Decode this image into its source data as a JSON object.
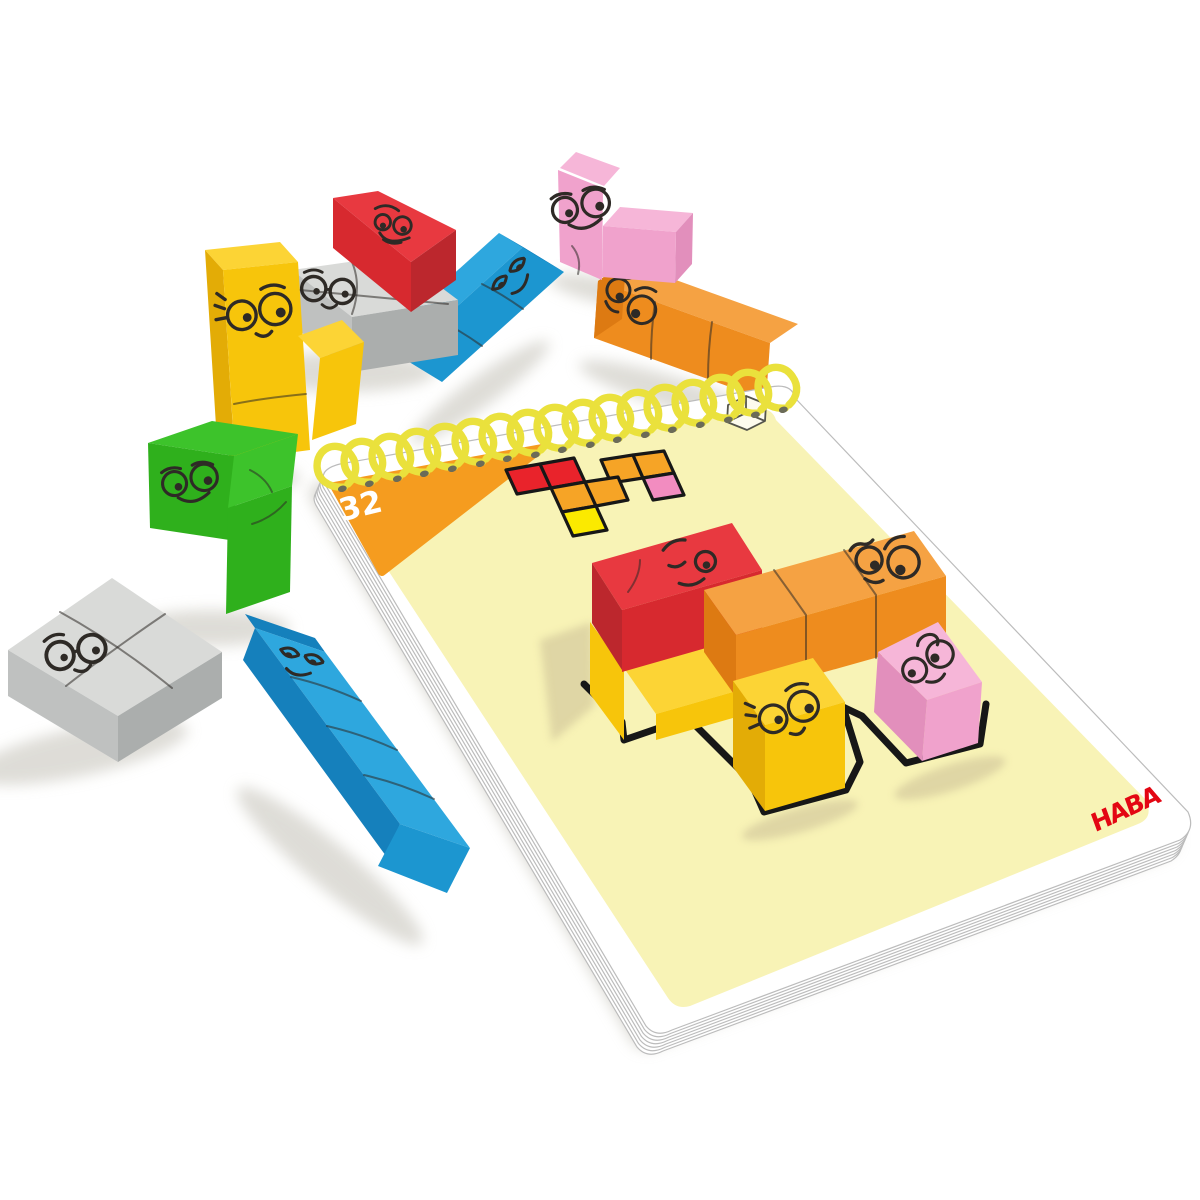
{
  "pad": {
    "brand": "HABA",
    "challenge_number": "32",
    "binding_style": "spiral",
    "icons": [
      {
        "name": "cube-3d-icon"
      }
    ]
  },
  "diagram": {
    "type": "grid",
    "description_icon": "solution-footprint-diagram",
    "cells": [
      {
        "color": "red",
        "col": 0,
        "row": 0
      },
      {
        "color": "red",
        "col": 1,
        "row": 0
      },
      {
        "color": "orange",
        "col": 3,
        "row": 0
      },
      {
        "color": "orange",
        "col": 4,
        "row": 0
      },
      {
        "color": "orange",
        "col": 1,
        "row": 1
      },
      {
        "color": "orange",
        "col": 2,
        "row": 1
      },
      {
        "color": "pink",
        "col": 4,
        "row": 1
      },
      {
        "color": "yellow",
        "col": 1,
        "row": 2
      }
    ]
  },
  "blocks_on_card": [
    {
      "name": "red-rectangle-block",
      "color": "red",
      "expression": "skeptical-face"
    },
    {
      "name": "orange-long-block",
      "color": "orange",
      "expression": "googly-eyes-face"
    },
    {
      "name": "yellow-corner-block",
      "color": "yellow",
      "expression": "sweet-face-with-lashes"
    },
    {
      "name": "pink-corner-block",
      "color": "pink",
      "expression": "dizzy-swirl-face"
    }
  ],
  "loose_blocks": [
    {
      "name": "yellow-l-block",
      "color": "yellow",
      "expression": "smiling-face-with-lashes"
    },
    {
      "name": "red-rectangle-block",
      "color": "red",
      "expression": "mischievous-face"
    },
    {
      "name": "gray-square-block",
      "color": "gray",
      "expression": "glasses-face"
    },
    {
      "name": "pink-t-block",
      "color": "pink",
      "expression": "big-smile-face"
    },
    {
      "name": "blue-long-block",
      "color": "blue",
      "expression": "smug-face"
    },
    {
      "name": "orange-long-block",
      "color": "orange",
      "expression": "googly-eyes-face"
    },
    {
      "name": "green-s-block",
      "color": "green",
      "expression": "happy-face"
    },
    {
      "name": "gray-flat-square-block",
      "color": "gray",
      "expression": "round-glasses-face"
    },
    {
      "name": "blue-extra-long-block",
      "color": "blue",
      "expression": "sleepy-smug-face"
    }
  ],
  "colors": {
    "card": "#F8F3B6",
    "page_edge": "#bcbcbc",
    "table_shadow": "#d6d4cd",
    "card_shadow": "#cfc399",
    "triangle": "#F59C1F",
    "number_text": "#FFFFFF",
    "brand_red": "#E30613",
    "spiral": "#EAE13C",
    "hole": "#6b6b58",
    "outline_ink": "#171717",
    "doodle_ink": "#2e2a26",
    "diagram_red": "#E9232B",
    "diagram_orange": "#F6A426",
    "diagram_yellow": "#FBEA00",
    "diagram_pink": "#F28CC0",
    "red_top": "#E83940",
    "red_front": "#D7292F",
    "red_side": "#BC272D",
    "orange_top": "#F5A243",
    "orange_front": "#EE8C1E",
    "orange_side": "#DD7A12",
    "yellow_top": "#FCD435",
    "yellow_front": "#F7C50B",
    "yellow_side": "#E3AC06",
    "green_top": "#3DC32B",
    "green_front": "#2FB01C",
    "green_side": "#27A015",
    "blue_top": "#2EA7DE",
    "blue_front": "#1C96D0",
    "blue_side": "#1580BC",
    "pink_top": "#F6B6D8",
    "pink_front": "#F0A2CC",
    "pink_side": "#E28FBC",
    "gray_top": "#D9DAD8",
    "gray_front": "#BFC1C0",
    "gray_side": "#ABAEAD"
  }
}
